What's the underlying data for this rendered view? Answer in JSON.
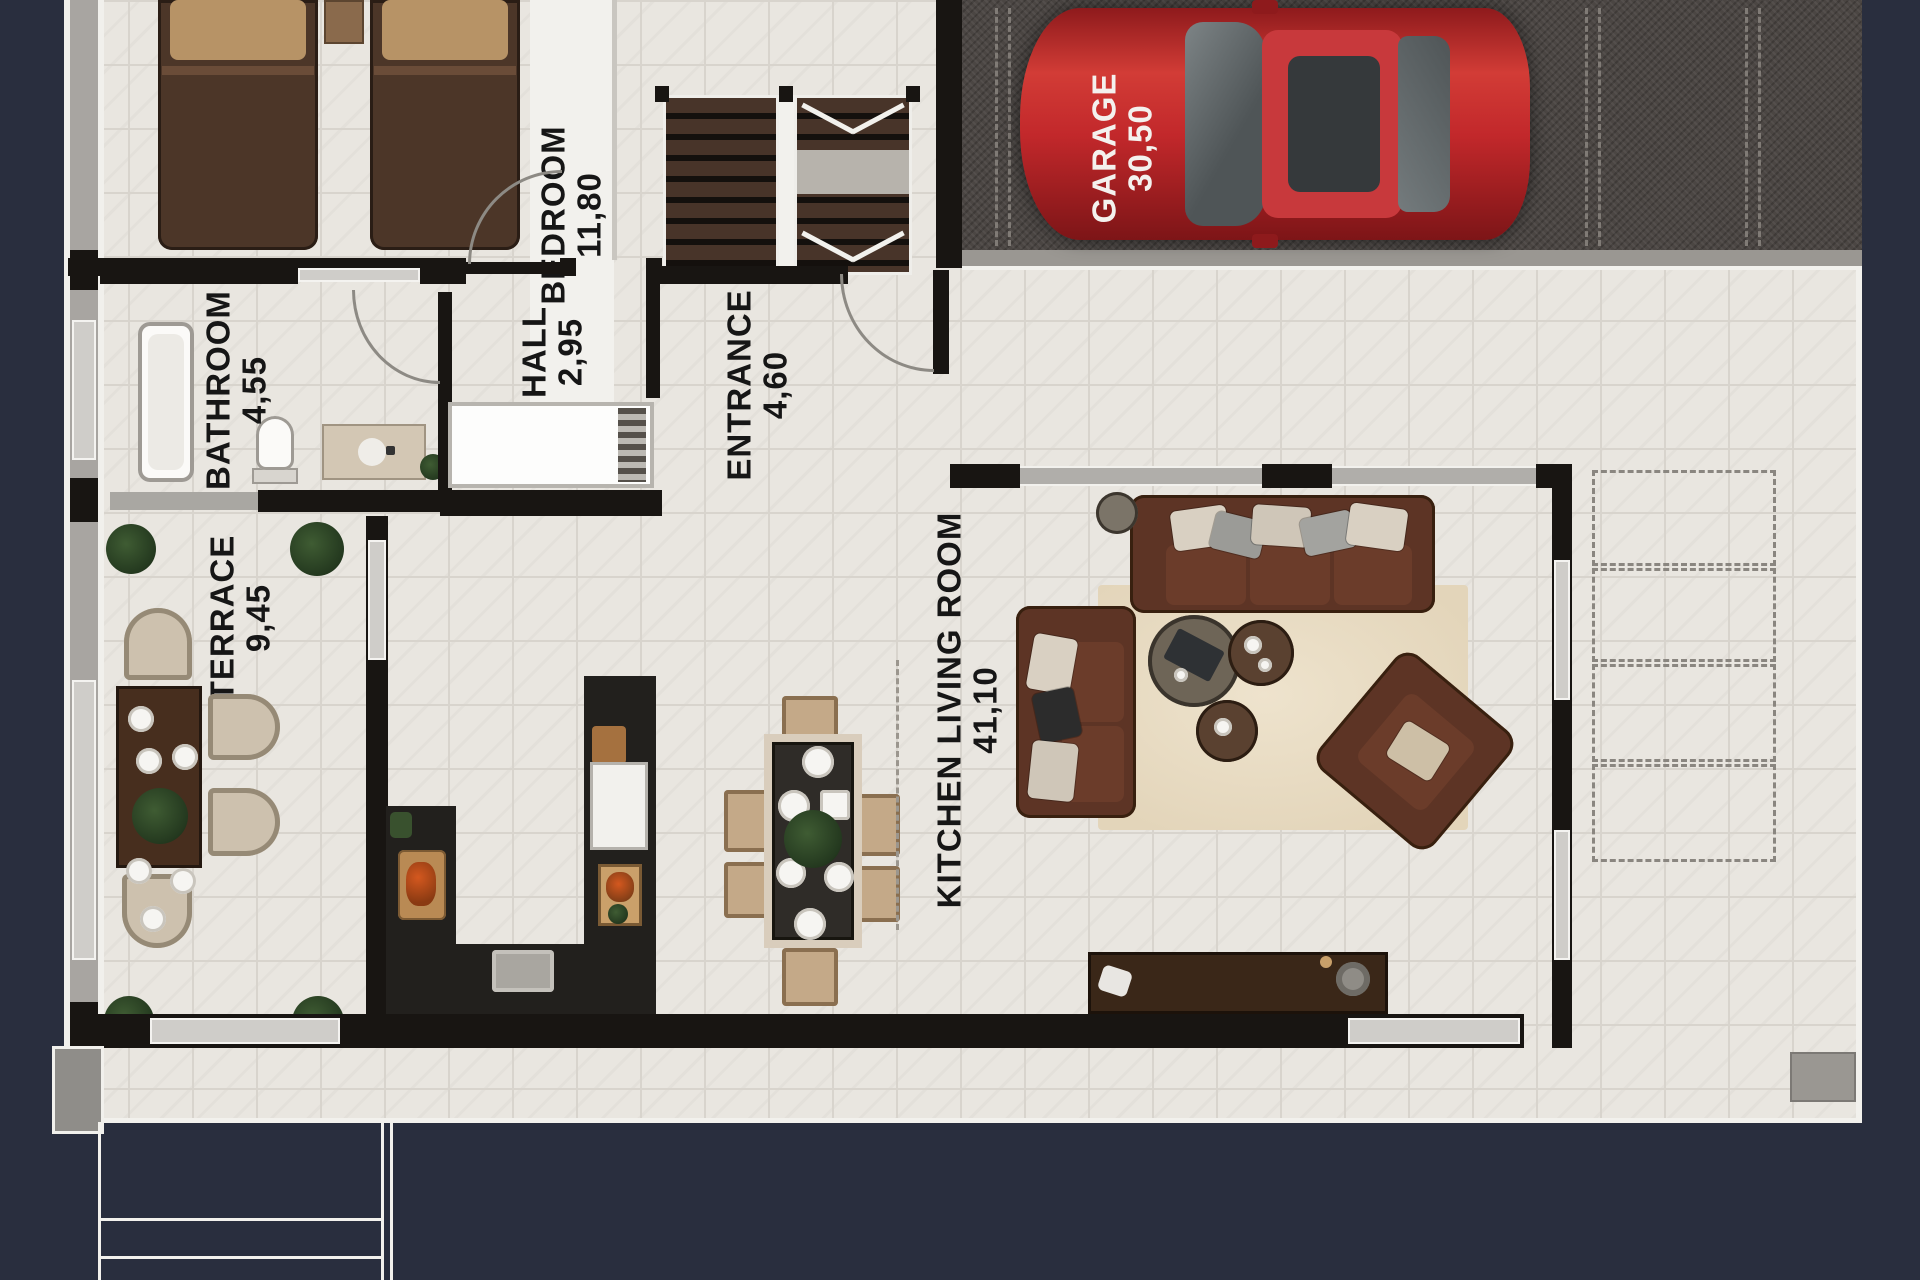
{
  "plan_title": "villa ground floor plan",
  "rooms": {
    "bedroom": {
      "name": "BEDROOM",
      "area": "11,80"
    },
    "bathroom": {
      "name": "BATHROOM",
      "area": "4,55"
    },
    "hall": {
      "name": "HALL",
      "area": "2,95"
    },
    "entrance": {
      "name": "ENTRANCE",
      "area": "4,60"
    },
    "terrace": {
      "name": "TERRACE",
      "area": "9,45"
    },
    "living": {
      "name": "KITCHEN LIVING ROOM",
      "area": "41,10"
    },
    "garage": {
      "name": "GARAGE",
      "area": "30,50"
    }
  },
  "colors": {
    "background": "#292e3e",
    "floor_tile": "#e9e6e0",
    "wall_black": "#181512",
    "wall_gray": "#a8a5a1",
    "garage_floor": "#4b4643",
    "car_red": "#c2282b",
    "sofa_brown": "#5d3425",
    "rug_beige": "#e8dcc5",
    "plant_green": "#24391f",
    "label_text": "#161616",
    "garage_label_text": "#f4f1ee"
  }
}
